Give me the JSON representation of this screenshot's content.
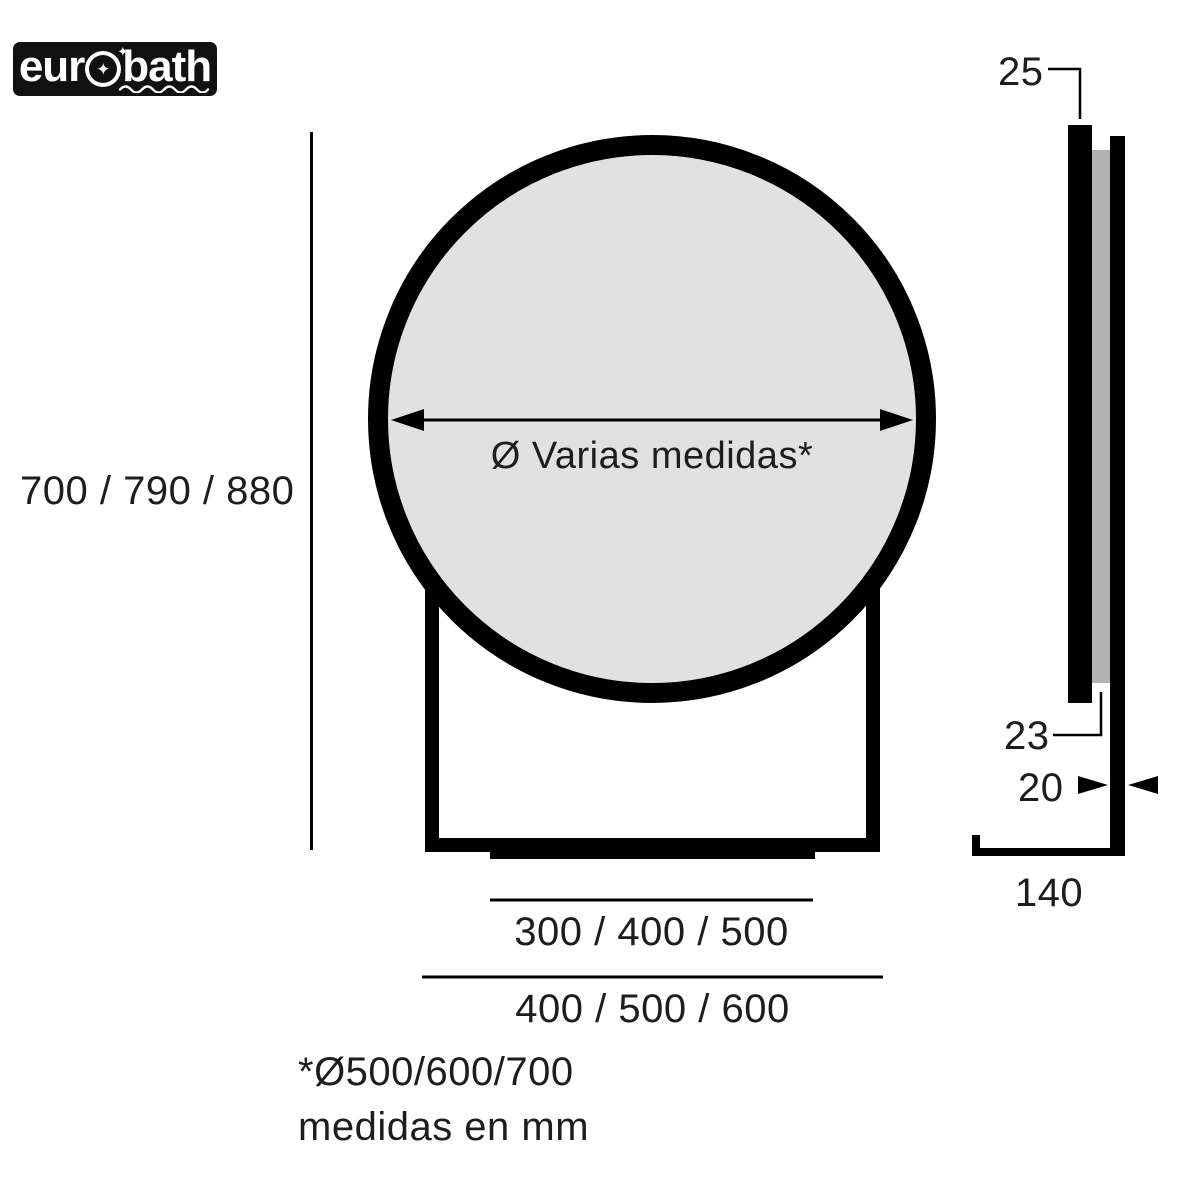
{
  "brand": {
    "prefix": "eur",
    "suffix": "bath",
    "o_star": "✦",
    "sparkle": "✦"
  },
  "front_view": {
    "diameter_label": "Ø Varias medidas*",
    "height_label": "700 / 790 / 880",
    "inner_width_label": "300 / 400 / 500",
    "outer_width_label": "400 / 500 / 600"
  },
  "side_view": {
    "mirror_thickness": "25",
    "backplate_thickness": "23",
    "profile_thickness": "20",
    "base_depth": "140"
  },
  "footnotes": {
    "diameter_options": "*Ø500/600/700",
    "units": "medidas en mm"
  },
  "colors": {
    "line_black": "#000000",
    "mirror_fill": "#e1e1e1",
    "backplate_gray": "#b0b3b2",
    "logo_bg": "#111111",
    "logo_text": "#ffffff"
  }
}
